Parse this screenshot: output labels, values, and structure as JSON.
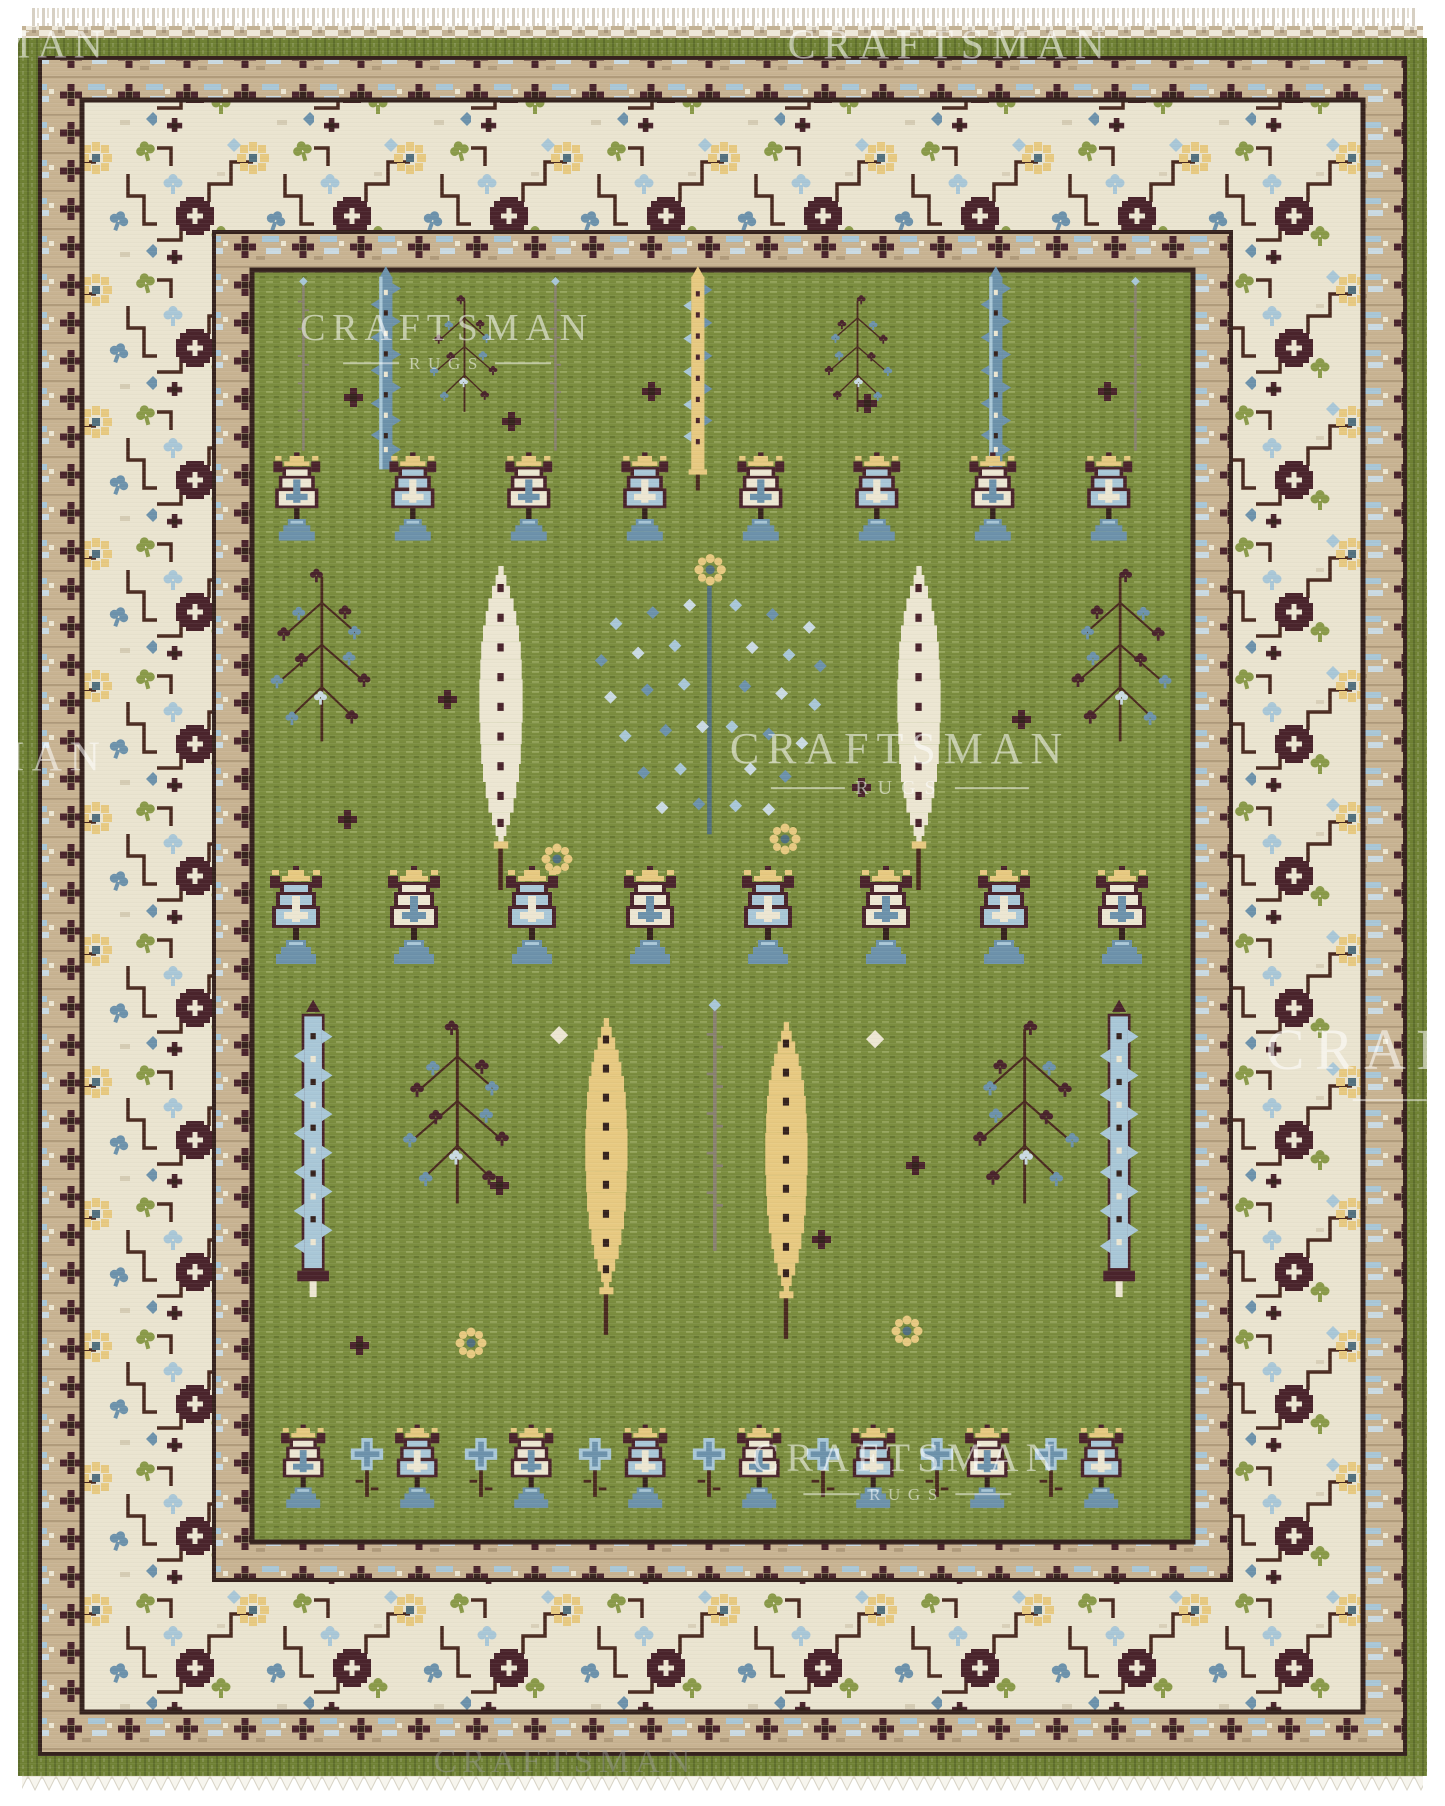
{
  "image": {
    "domain": "product-photograph",
    "subject": "Hand-knotted wool area rug, green field with stylized tree-of-life, cypress, willow and vase motifs, ivory floral vine borders, tan guard bands, green selvedge and white fringe at top and bottom edges",
    "style": "Arts and Crafts / Oushak tree design",
    "orientation": "portrait"
  },
  "watermark": {
    "brand": "CRAFTSMAN",
    "sub": "RUGS"
  },
  "colors": {
    "background": "#ffffff",
    "field_green": "#7b8d3f",
    "selvedge_green": "#6f8134",
    "guard_tan": "#c8b392",
    "border_ivory": "#eae4d0",
    "outline_brown": "#36231e",
    "burgundy": "#4a242c",
    "vine_brown": "#4a2a20",
    "steel_blue": "#6d92ab",
    "sky_blue": "#a9c7d7",
    "pale_blue": "#cadae2",
    "gold": "#e7c981",
    "cream": "#ece6d2",
    "leaf_green": "#8a9a49",
    "blue_gray": "#52707e",
    "trunk_gray": "#8a8272",
    "fringe_white": "#f7f5ee",
    "flatweave_tan": "#c3b295",
    "watermark_white": "rgba(255,255,255,0.55)",
    "watermark_gray": "rgba(155,155,155,0.45)"
  }
}
